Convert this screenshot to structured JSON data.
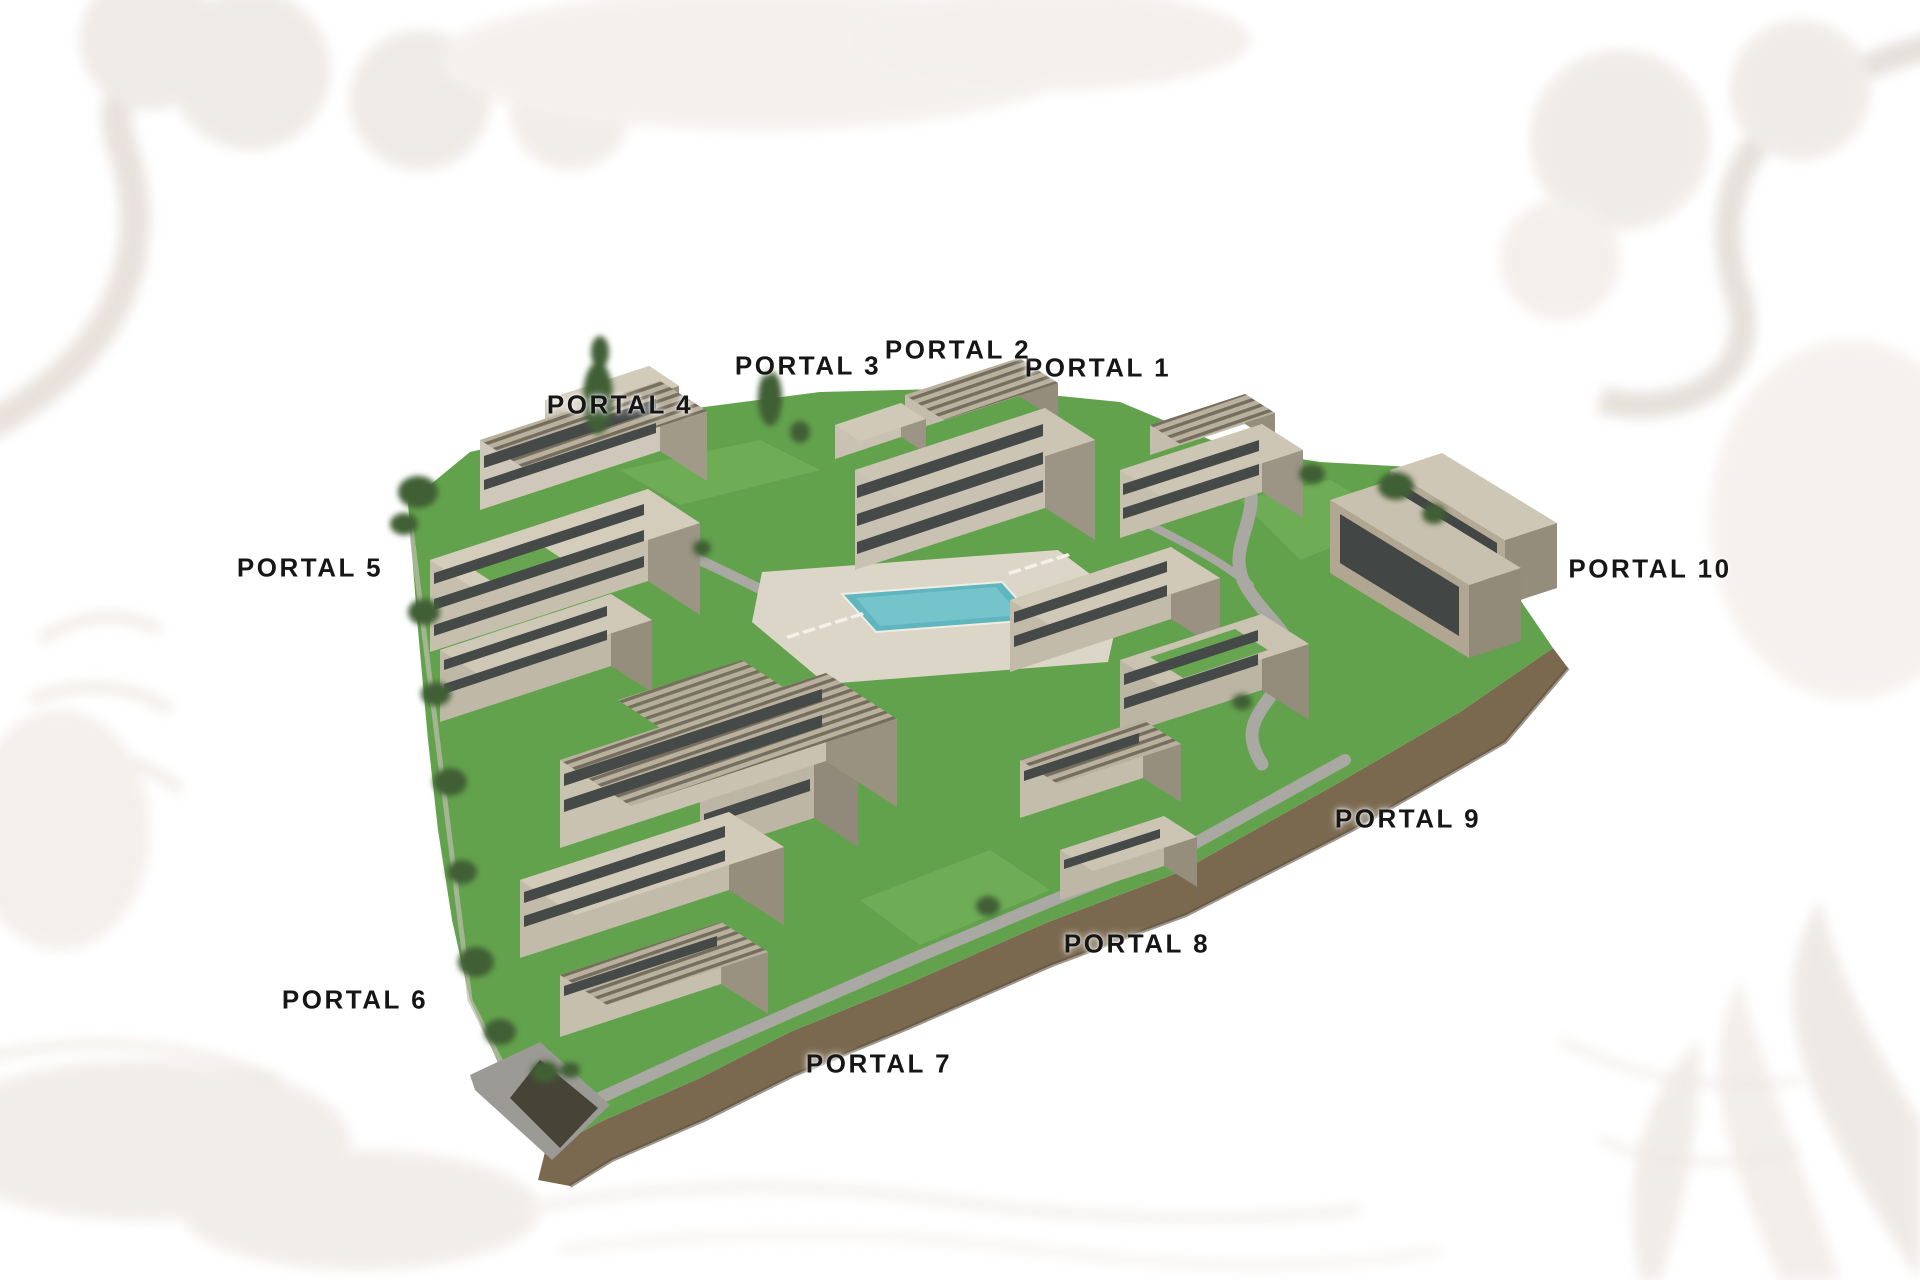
{
  "portals": [
    {
      "id": 1,
      "label": "PORTAL 1"
    },
    {
      "id": 2,
      "label": "PORTAL 2"
    },
    {
      "id": 3,
      "label": "PORTAL 3"
    },
    {
      "id": 4,
      "label": "PORTAL 4"
    },
    {
      "id": 5,
      "label": "PORTAL 5"
    },
    {
      "id": 6,
      "label": "PORTAL 6"
    },
    {
      "id": 7,
      "label": "PORTAL 7"
    },
    {
      "id": 8,
      "label": "PORTAL 8"
    },
    {
      "id": 9,
      "label": "PORTAL 9"
    },
    {
      "id": 10,
      "label": "PORTAL 10"
    }
  ],
  "palette": {
    "label_text": "#161616",
    "grass": "#63a24c",
    "earth_embankment": "#7a694f",
    "pool_water": "#5fb6bf",
    "building_light": "#d4cdbc",
    "building_shade": "#9c9484",
    "path_gray": "#a9a8a2",
    "background": "#ffffff"
  }
}
